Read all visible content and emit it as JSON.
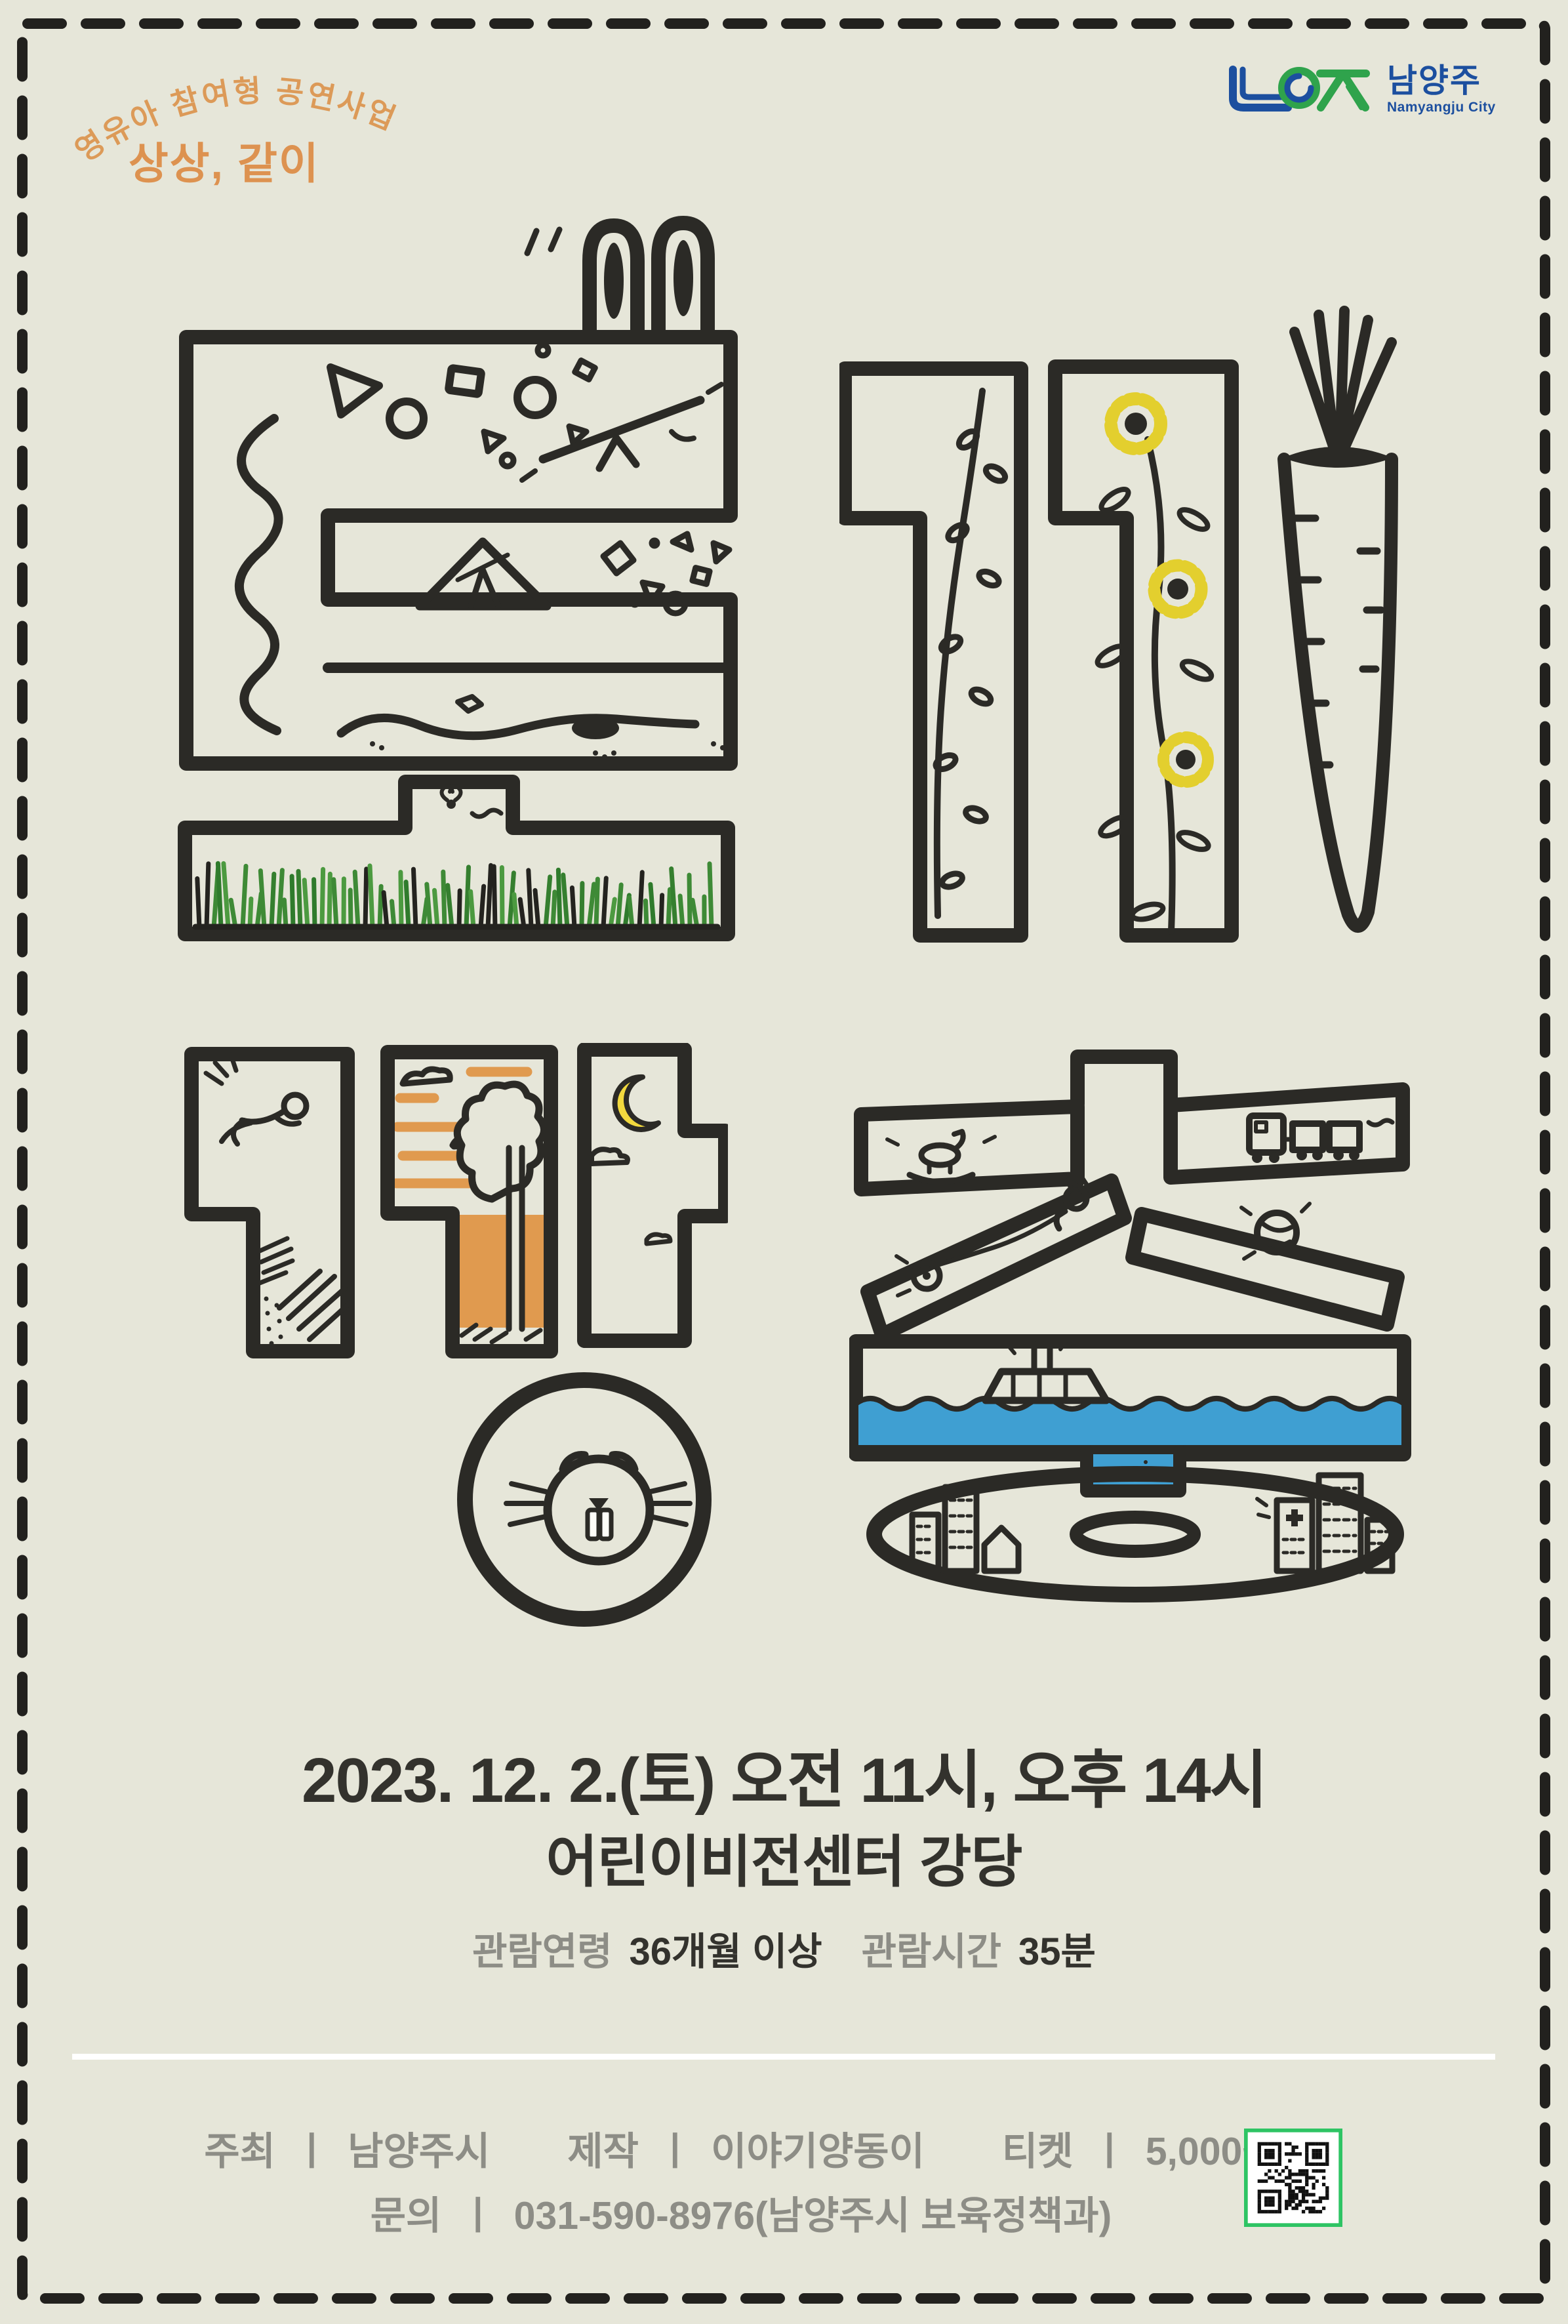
{
  "header": {
    "arc_label": "영유아 참여형 공연사업",
    "program_title": "상상, 같이",
    "logo": {
      "symbol": "namyangju-city-emblem",
      "name_kr": "남양주",
      "name_en": "Namyangju City"
    }
  },
  "artwork": {
    "title_reading": "토끼 깡총",
    "top_word": "토끼",
    "bottom_word": "깡총",
    "motifs": [
      "rabbit-ears",
      "geometric-shapes",
      "seesaw",
      "tent",
      "spiral-scribble",
      "grass",
      "butterfly",
      "wildflower-branch",
      "sunflowers",
      "carrot",
      "running-child",
      "sunset-clouds-tree",
      "crescent-moon",
      "clouds",
      "beaver-face",
      "rocking-horse",
      "toy-train",
      "cat-and-yoyo",
      "yarn-ball",
      "boat-with-rabbit-ears",
      "waves",
      "fish",
      "city-buildings"
    ]
  },
  "details": {
    "schedule": "2023. 12. 2.(토) 오전 11시, 오후 14시",
    "venue": "어린이비전센터 강당",
    "age_label": "관람연령",
    "age_value": "36개월 이상",
    "time_label": "관람시간",
    "time_value": "35분"
  },
  "credits": {
    "sep": "ㅣ",
    "host_label": "주최",
    "host": "남양주시",
    "maker_label": "제작",
    "maker": "이야기양동이",
    "ticket_label": "티켓",
    "ticket": "5,000원",
    "inquiry_label": "문의",
    "inquiry": "031-590-8976(남양주시 보육정책과)"
  },
  "colors": {
    "background": "#e6e6d9",
    "ink": "#2b2a26",
    "accent_orange": "#dd9250",
    "sunset_orange": "#e09a4f",
    "text_dark": "#33322d",
    "text_gray": "#8d8d86",
    "grass_green": "#3e8a36",
    "water_blue": "#3f9fd2",
    "flower_yellow": "#e3cf2e",
    "moon_yellow": "#f2d93e",
    "logo_blue": "#1c4f9f",
    "logo_green": "#2fa34c",
    "qr_green": "#2ec464",
    "divider_white": "#ffffff"
  }
}
